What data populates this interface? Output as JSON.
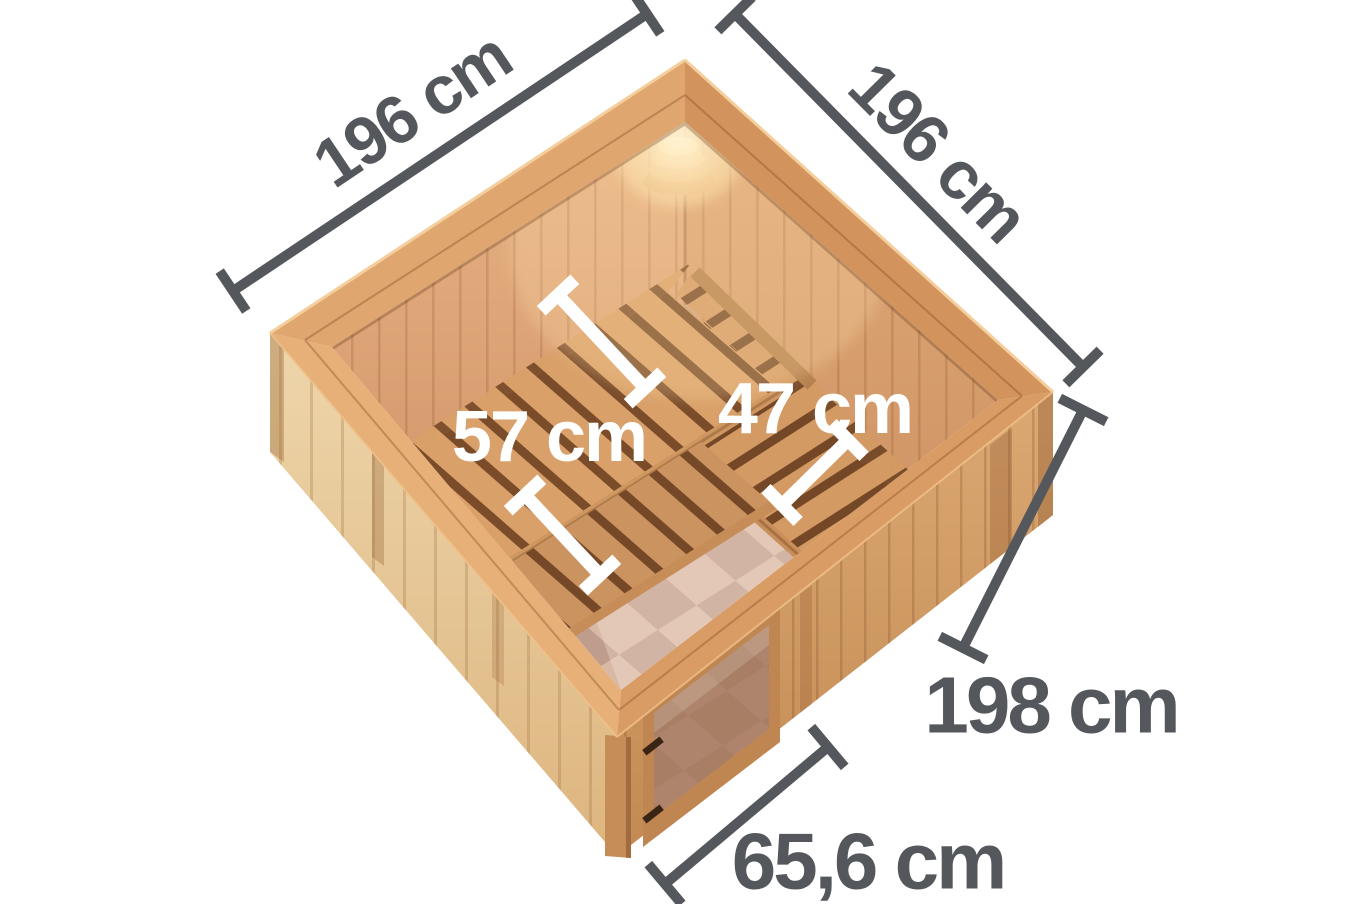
{
  "scene": {
    "background": "#ffffff",
    "annotation_color": "#54585c",
    "inner_annotation_color": "#ffffff"
  },
  "labels": {
    "outer_width_left": "196 cm",
    "outer_width_right": "196 cm",
    "bench_depth_main": "57 cm",
    "bench_depth_side": "47 cm",
    "outer_height": "198 cm",
    "door_width": "65,6 cm"
  }
}
